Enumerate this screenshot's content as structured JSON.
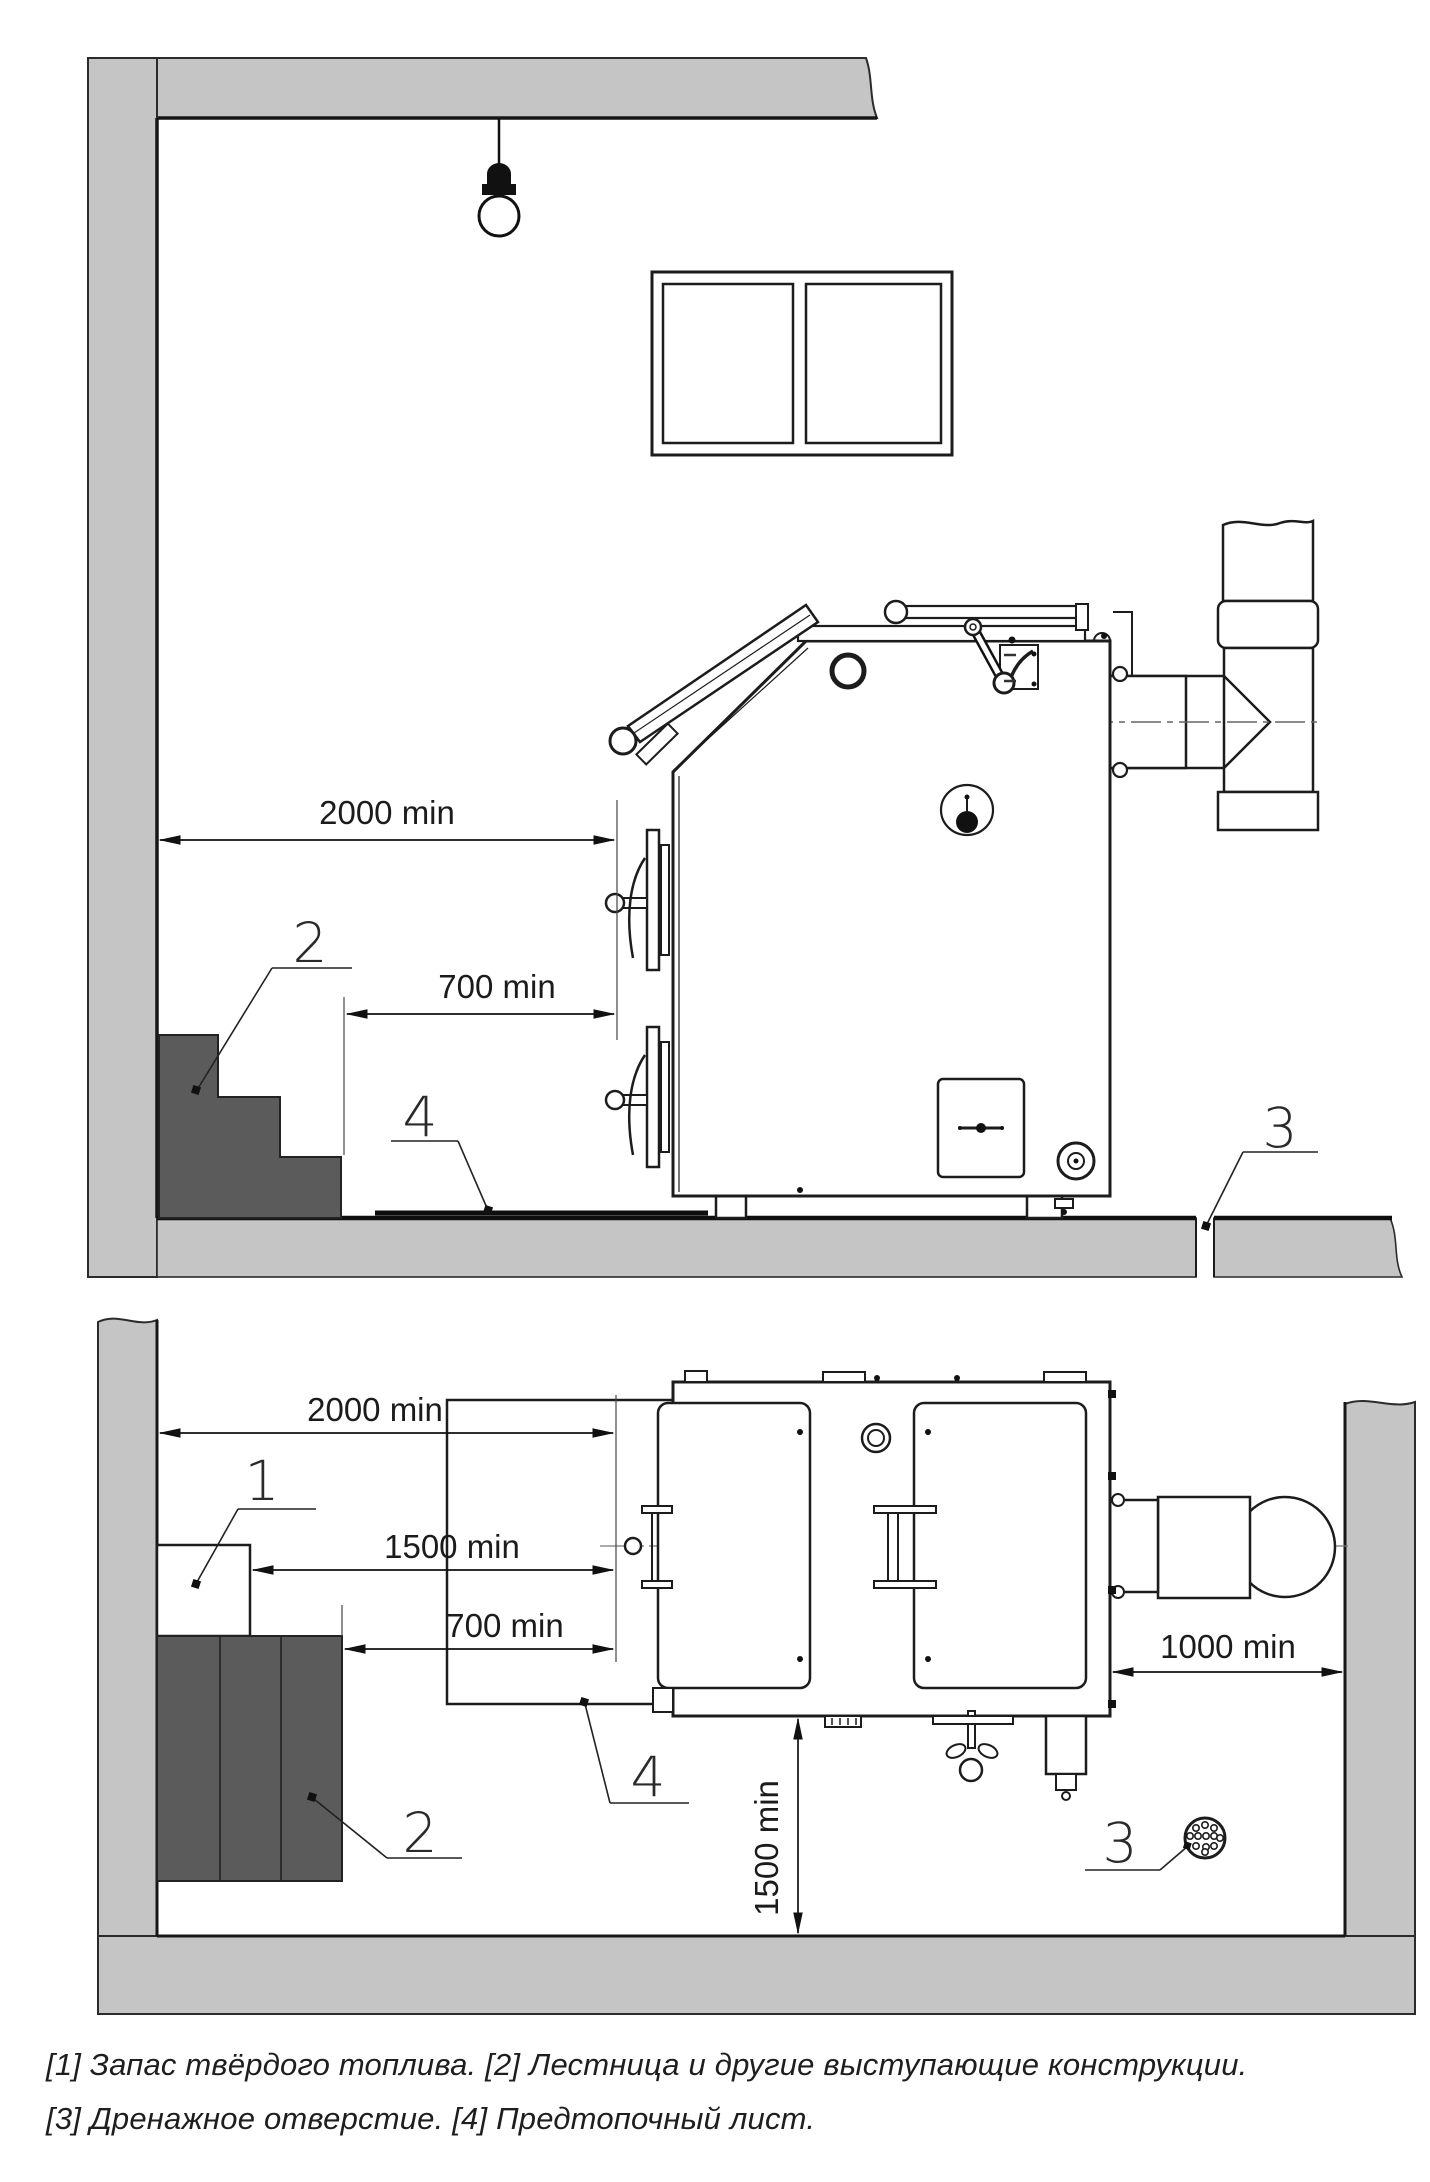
{
  "colors": {
    "wall_fill": "#c5c5c5",
    "dark_fill": "#5b5b5b",
    "line": "#1c1c1c"
  },
  "side_view": {
    "dim_wall_to_boiler": "2000 min",
    "dim_stairs_to_boiler": "700 min",
    "callout_stairs": "2",
    "callout_sheet": "4",
    "callout_drain": "3"
  },
  "plan_view": {
    "dim_wall_to_boiler": "2000 min",
    "dim_fuel_to_boiler": "1500 min",
    "dim_ladder_to_boiler": "700 min",
    "dim_boiler_to_wall": "1000 min",
    "dim_front_clearance": "1500 min",
    "callout_fuel": "1",
    "callout_ladder": "2",
    "callout_sheet": "4",
    "callout_drain": "3"
  },
  "legend": {
    "line1": "[1] Запас твёрдого топлива. [2] Лестница и другие выступающие конструкции.",
    "line2": "[3] Дренажное отверстие. [4] Предтопочный лист."
  }
}
